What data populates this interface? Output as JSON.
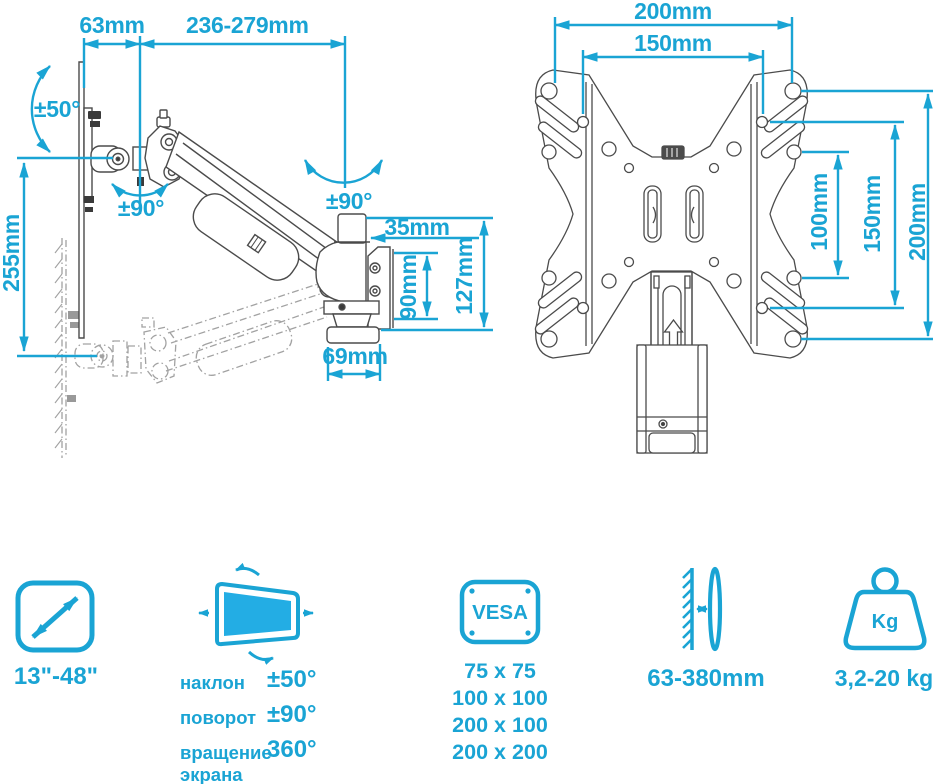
{
  "title": "TV wall mount bracket dimensions infographic",
  "colors": {
    "accent": "#1aa4d4",
    "screen_fill": "#23ade4",
    "drawing_line": "#4b4b4b",
    "ghost_line": "#a2a2a2"
  },
  "left_drawing": {
    "name": "arm side view",
    "dims": {
      "monitor_offset": "63mm",
      "arm_reach": "236-279mm",
      "tilt_range": "±50°",
      "arm_swivel": "±90°",
      "head_swivel": "±90°",
      "vertical_travel": "255mm",
      "post_width": "35mm",
      "plate_height": "90mm",
      "bracket_height": "127mm",
      "base_width": "69mm"
    }
  },
  "right_drawing": {
    "name": "vesa plate front view",
    "dims": {
      "hole_width_outer": "200mm",
      "hole_width_inner": "150mm",
      "hole_height_inner": "100mm",
      "hole_height_mid": "150mm",
      "hole_height_outer": "200mm"
    }
  },
  "specs": [
    {
      "id": "screen-size",
      "label": "13\"-48\""
    },
    {
      "id": "rotation",
      "rows": [
        {
          "name": "наклон",
          "value": "±50°"
        },
        {
          "name": "поворот",
          "value": "±90°"
        },
        {
          "name": "вращение экрана",
          "value": "360°"
        }
      ]
    },
    {
      "id": "vesa",
      "icon_text": "VESA",
      "sizes": [
        "75 x 75",
        "100 x 100",
        "200 x 100",
        "200 x 200"
      ]
    },
    {
      "id": "wall-distance",
      "label": "63-380mm"
    },
    {
      "id": "max-weight",
      "icon_text": "Kg",
      "label": "3,2-20 kg"
    }
  ]
}
